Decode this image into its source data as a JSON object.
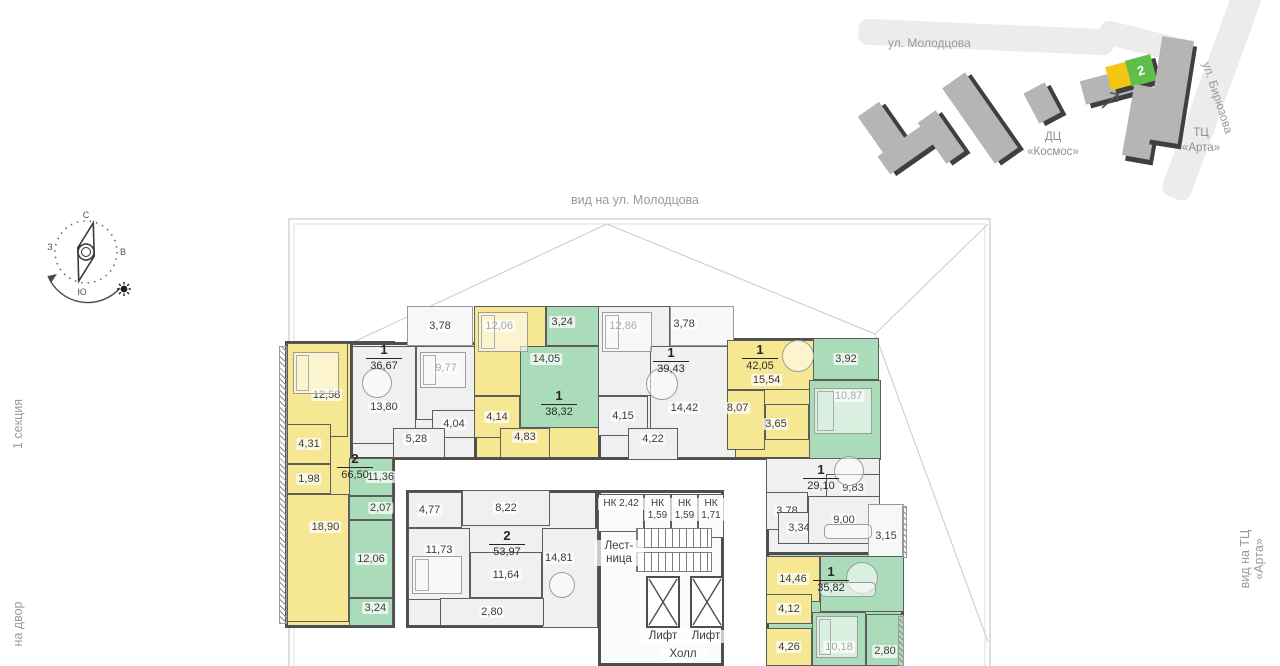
{
  "labels": {
    "top": "вид на ул. Молодцова",
    "left_top": "1 секция",
    "left_bottom": "на двор",
    "right": "вид на ТЦ «Арта»"
  },
  "minimap": {
    "street1": "ул. Молодцова",
    "street2": "ул. Бирюзова",
    "b1_line1": "ДЦ",
    "b1_line2": "«Космос»",
    "b2_line1": "ТЦ",
    "b2_line2": "«Арта»",
    "badge": "2",
    "colors": {
      "yellow": "#f3c613",
      "green": "#5fbf4a",
      "gray": "#b5b5b5",
      "dark": "#3f3f3f",
      "road": "#ececec"
    }
  },
  "compass": {
    "n": "С",
    "e": "В",
    "s": "Ю",
    "w": "З"
  },
  "plan": {
    "wall": "#4f4f4f",
    "colors": {
      "y": "#f6e793",
      "g": "#abdcba",
      "n": "#f0f0f0",
      "b": "#f7f7f7",
      "w": "#fbfbfb"
    },
    "shells": [
      [
        285,
        341,
        110,
        287,
        "y"
      ],
      [
        350,
        342,
        128,
        118,
        "n"
      ],
      [
        474,
        342,
        128,
        118,
        "y"
      ],
      [
        598,
        342,
        140,
        118,
        "n"
      ],
      [
        726,
        338,
        92,
        122,
        "y"
      ],
      [
        766,
        458,
        114,
        100,
        "n"
      ],
      [
        766,
        552,
        138,
        114,
        "g"
      ],
      [
        406,
        490,
        192,
        138,
        "n"
      ],
      [
        598,
        490,
        126,
        176,
        "w"
      ]
    ],
    "apartments": [
      {
        "badge": {
          "x": 332,
          "y": 450,
          "n": "2",
          "a": "66,50"
        },
        "rooms": [
          [
            287,
            343,
            61,
            94,
            "y",
            "12,58",
            0.65,
            0.55
          ],
          [
            287,
            424,
            44,
            40,
            "y",
            "4,31",
            0.5,
            0.5
          ],
          [
            287,
            464,
            44,
            30,
            "y",
            "1,98",
            0.5,
            0.5
          ],
          [
            287,
            494,
            62,
            128,
            "y",
            "18,90",
            0.62,
            0.26
          ],
          [
            349,
            458,
            44,
            38,
            "g",
            "11,36",
            0.72,
            0.5
          ],
          [
            349,
            496,
            44,
            24,
            "g",
            "2,07",
            0.72,
            0.5
          ],
          [
            349,
            520,
            44,
            78,
            "g",
            "12,06",
            0.5,
            0.5
          ],
          [
            349,
            598,
            44,
            28,
            "g",
            "3,24",
            0.6,
            0.35
          ]
        ]
      },
      {
        "badge": {
          "x": 361,
          "y": 341,
          "n": "1",
          "a": "36,67"
        },
        "rooms": [
          [
            407,
            306,
            66,
            40,
            "b",
            "3,78",
            0.5,
            0.5
          ],
          [
            352,
            346,
            64,
            98,
            "n",
            "13,80",
            0.5,
            0.62
          ],
          [
            416,
            346,
            60,
            74,
            "n",
            "9,77",
            0.5,
            0.3
          ],
          [
            432,
            410,
            44,
            28,
            "n",
            "4,04",
            0.5,
            0.5
          ],
          [
            393,
            428,
            52,
            30,
            "n",
            "5,28",
            0.45,
            0.35
          ]
        ]
      },
      {
        "badge": {
          "x": 536,
          "y": 387,
          "n": "1",
          "a": "38,32"
        },
        "rooms": [
          [
            474,
            306,
            72,
            90,
            "y",
            "12,06",
            0.35,
            0.22
          ],
          [
            546,
            306,
            54,
            40,
            "g",
            "3,24",
            0.3,
            0.4
          ],
          [
            520,
            346,
            80,
            82,
            "g",
            "14,05",
            0.33,
            0.16
          ],
          [
            474,
            396,
            46,
            42,
            "y",
            "4,14",
            0.5,
            0.5
          ],
          [
            500,
            428,
            50,
            30,
            "y",
            "4,83",
            0.5,
            0.3
          ]
        ]
      },
      {
        "badge": {
          "x": 648,
          "y": 344,
          "n": "1",
          "a": "39,43"
        },
        "rooms": [
          [
            598,
            306,
            72,
            90,
            "n",
            "12,86",
            0.35,
            0.22
          ],
          [
            670,
            306,
            64,
            40,
            "b",
            "3,78",
            0.22,
            0.45
          ],
          [
            650,
            346,
            86,
            112,
            "n",
            "14,42",
            0.4,
            0.55
          ],
          [
            598,
            396,
            50,
            40,
            "n",
            "4,15",
            0.5,
            0.5
          ],
          [
            628,
            428,
            50,
            32,
            "n",
            "4,22",
            0.5,
            0.35
          ]
        ]
      },
      {
        "badge": {
          "x": 737,
          "y": 341,
          "n": "1",
          "a": "42,05"
        },
        "rooms": [
          [
            727,
            340,
            88,
            50,
            "y",
            "15,54",
            0.45,
            0.8
          ],
          [
            727,
            390,
            38,
            60,
            "y",
            "8,07",
            0.28,
            0.3
          ],
          [
            765,
            404,
            44,
            36,
            "y",
            "3,65",
            0.25,
            0.55
          ],
          [
            813,
            338,
            66,
            42,
            "g",
            "3,92",
            0.5,
            0.5
          ],
          [
            809,
            380,
            72,
            80,
            "g",
            "10,87",
            0.55,
            0.2
          ]
        ]
      },
      {
        "badge": {
          "x": 798,
          "y": 461,
          "n": "1",
          "a": "29,10"
        },
        "rooms": [
          [
            766,
            458,
            114,
            40,
            "n",
            "",
            0.5,
            0.5
          ],
          [
            826,
            474,
            54,
            36,
            "n",
            "9,83",
            0.5,
            0.4
          ],
          [
            766,
            492,
            42,
            38,
            "n",
            "3,78",
            0.5,
            0.5
          ],
          [
            778,
            512,
            42,
            32,
            "n",
            "3,34",
            0.5,
            0.5
          ],
          [
            808,
            496,
            72,
            48,
            "n",
            "9,00",
            0.5,
            0.5
          ],
          [
            868,
            504,
            36,
            54,
            "b",
            "3,15",
            0.5,
            0.6
          ]
        ]
      },
      {
        "badge": {
          "x": 808,
          "y": 563,
          "n": "1",
          "a": "35,82"
        },
        "rooms": [
          [
            766,
            556,
            54,
            46,
            "y",
            "14,46",
            0.5,
            0.5
          ],
          [
            820,
            556,
            84,
            56,
            "g",
            "",
            0.5,
            0.5
          ],
          [
            766,
            594,
            46,
            30,
            "y",
            "4,12",
            0.5,
            0.5
          ],
          [
            766,
            628,
            46,
            38,
            "y",
            "4,26",
            0.5,
            0.5
          ],
          [
            812,
            612,
            54,
            54,
            "g",
            "10,18",
            0.5,
            0.65
          ],
          [
            866,
            614,
            38,
            52,
            "g",
            "2,80",
            0.5,
            0.72
          ]
        ]
      },
      {
        "badge": {
          "x": 484,
          "y": 527,
          "n": "2",
          "a": "53,97"
        },
        "rooms": [
          [
            408,
            492,
            54,
            36,
            "n",
            "4,77",
            0.4,
            0.5
          ],
          [
            462,
            490,
            88,
            36,
            "n",
            "8,22",
            0.5,
            0.5
          ],
          [
            408,
            528,
            62,
            72,
            "n",
            "11,73",
            0.5,
            0.3
          ],
          [
            470,
            552,
            72,
            46,
            "n",
            "11,64",
            0.5,
            0.5
          ],
          [
            542,
            528,
            56,
            100,
            "n",
            "14,81",
            0.3,
            0.3
          ],
          [
            440,
            598,
            104,
            28,
            "n",
            "2,80",
            0.5,
            0.5
          ]
        ]
      }
    ],
    "core": {
      "storage": [
        {
          "x": 598,
          "y": 494,
          "w": 46,
          "h": 38,
          "lines": [
            "НК 2,42"
          ]
        },
        {
          "x": 644,
          "y": 494,
          "w": 27,
          "h": 44,
          "lines": [
            "НК",
            "1,59"
          ]
        },
        {
          "x": 671,
          "y": 494,
          "w": 27,
          "h": 44,
          "lines": [
            "НК",
            "1,59"
          ]
        },
        {
          "x": 698,
          "y": 494,
          "w": 26,
          "h": 44,
          "lines": [
            "НК",
            "1,71"
          ]
        }
      ],
      "stairs_label": "Лест-\nница",
      "stairs_label_pos": [
        594,
        540,
        50
      ],
      "flights": [
        [
          636,
          528,
          76,
          20
        ],
        [
          636,
          552,
          76,
          20
        ]
      ],
      "lifts": [
        [
          646,
          576,
          34,
          52
        ],
        [
          690,
          576,
          34,
          52
        ]
      ],
      "lift_text": "Лифт",
      "lift_labels": [
        [
          641,
          630
        ],
        [
          684,
          630
        ]
      ],
      "hall_text": "Холл",
      "hall_pos": [
        658,
        648
      ]
    },
    "strips": [
      [
        279,
        346,
        8,
        278
      ],
      [
        902,
        506,
        5,
        52
      ],
      [
        898,
        616,
        6,
        50
      ]
    ],
    "furniture": {
      "beds": [
        [
          293,
          352,
          46,
          42
        ],
        [
          478,
          312,
          50,
          40
        ],
        [
          602,
          312,
          50,
          40
        ],
        [
          814,
          388,
          58,
          46
        ],
        [
          412,
          556,
          50,
          38
        ],
        [
          816,
          616,
          42,
          42
        ],
        [
          420,
          352,
          46,
          36
        ]
      ],
      "tables": [
        [
          362,
          368,
          30
        ],
        [
          646,
          368,
          32
        ],
        [
          834,
          456,
          30
        ],
        [
          782,
          340,
          32
        ],
        [
          846,
          562,
          32
        ],
        [
          549,
          572,
          26
        ]
      ],
      "sofas": [
        [
          824,
          524,
          48,
          15
        ],
        [
          820,
          582,
          56,
          15
        ]
      ]
    }
  }
}
